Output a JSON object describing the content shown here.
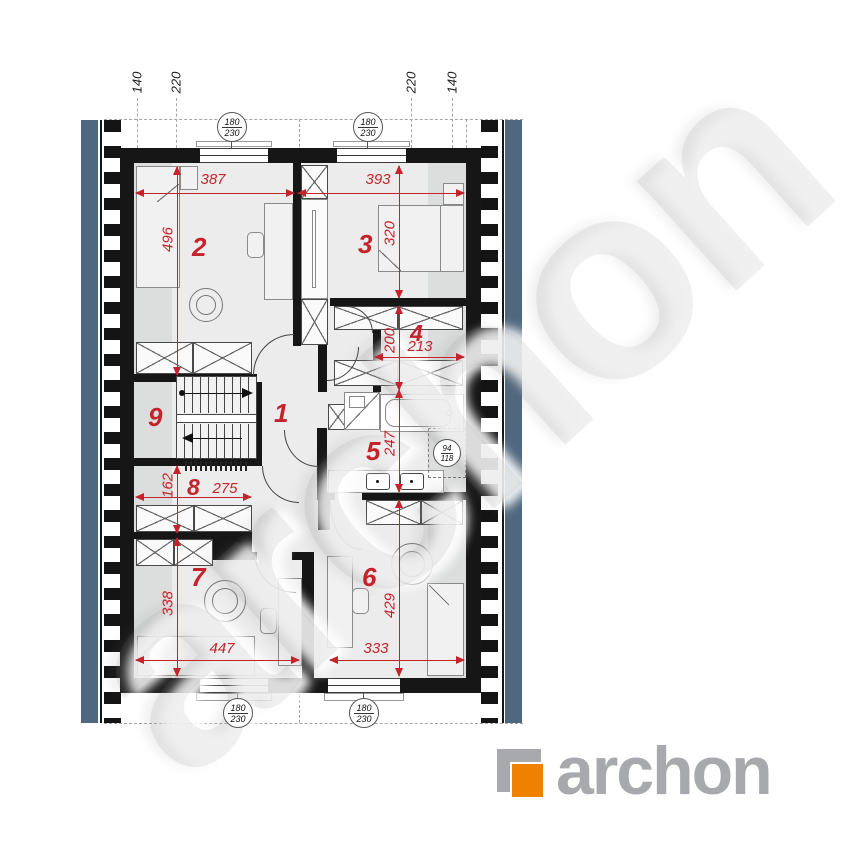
{
  "watermark": {
    "text": "archon"
  },
  "brand": {
    "logo_text": "archon",
    "logo_gray": "#a7a9ac",
    "logo_orange": "#f08100"
  },
  "colors": {
    "roof_band": "#50687f",
    "wall": "#161616",
    "dim_red": "#c4232b",
    "floor": "#ececec",
    "floor_low": "#dcdddd"
  },
  "top_dimension_ticks": [
    "140",
    "220",
    "220",
    "140"
  ],
  "rooms": [
    {
      "number": "1"
    },
    {
      "number": "2"
    },
    {
      "number": "3"
    },
    {
      "number": "4"
    },
    {
      "number": "5"
    },
    {
      "number": "6"
    },
    {
      "number": "7"
    },
    {
      "number": "8"
    },
    {
      "number": "9"
    }
  ],
  "dimensions": [
    {
      "value": "387",
      "room": "2",
      "orientation": "horizontal"
    },
    {
      "value": "496",
      "room": "2",
      "orientation": "vertical"
    },
    {
      "value": "393",
      "room": "3",
      "orientation": "horizontal"
    },
    {
      "value": "320",
      "room": "3",
      "orientation": "vertical"
    },
    {
      "value": "213",
      "room": "4",
      "orientation": "horizontal"
    },
    {
      "value": "200",
      "room": "4",
      "orientation": "vertical"
    },
    {
      "value": "247",
      "room": "5",
      "orientation": "vertical"
    },
    {
      "value": "275",
      "room": "8",
      "orientation": "horizontal"
    },
    {
      "value": "162",
      "room": "8",
      "orientation": "vertical"
    },
    {
      "value": "447",
      "room": "7",
      "orientation": "horizontal"
    },
    {
      "value": "338",
      "room": "7",
      "orientation": "vertical"
    },
    {
      "value": "333",
      "room": "6",
      "orientation": "horizontal"
    },
    {
      "value": "429",
      "room": "6",
      "orientation": "vertical"
    }
  ],
  "window_markers": [
    {
      "numerator": "180",
      "denominator": "230",
      "position": "top-left"
    },
    {
      "numerator": "180",
      "denominator": "230",
      "position": "top-right"
    },
    {
      "numerator": "180",
      "denominator": "230",
      "position": "bottom-left"
    },
    {
      "numerator": "180",
      "denominator": "230",
      "position": "bottom-right"
    },
    {
      "numerator": "94",
      "denominator": "118",
      "position": "bathroom-roof-window"
    }
  ]
}
